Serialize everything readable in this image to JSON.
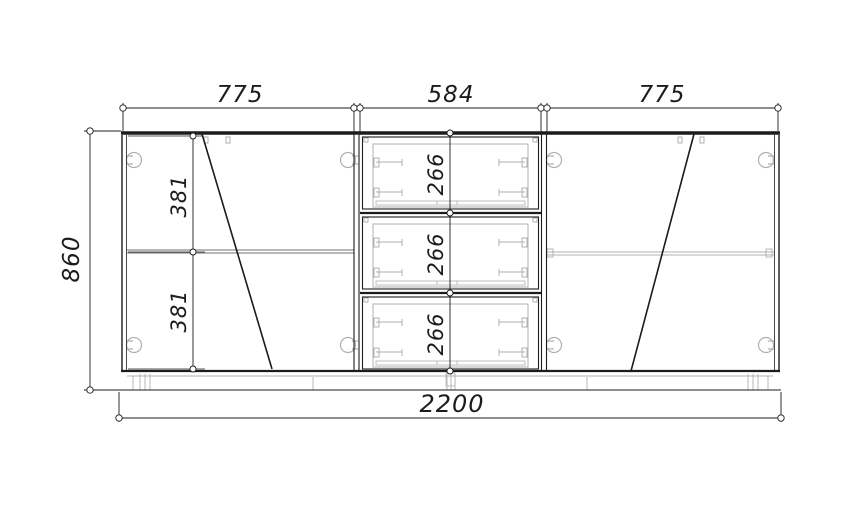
{
  "drawing": {
    "type": "cabinet-front-elevation",
    "units": "mm",
    "overall": {
      "width": "2200",
      "height": "860"
    },
    "top_dims": [
      "775",
      "584",
      "775"
    ],
    "left_section_dims": [
      "381",
      "381"
    ],
    "drawer_dims": [
      "266",
      "266",
      "266"
    ],
    "sections": {
      "left": "hinged door with shelf, swing line",
      "middle": "three drawers",
      "right": "hinged door with shelf, swing line"
    },
    "colors": {
      "line": "#1c1c1c",
      "detail": "#b0b0b0",
      "shelf": "#6f6f6f",
      "background": "#ffffff"
    }
  }
}
